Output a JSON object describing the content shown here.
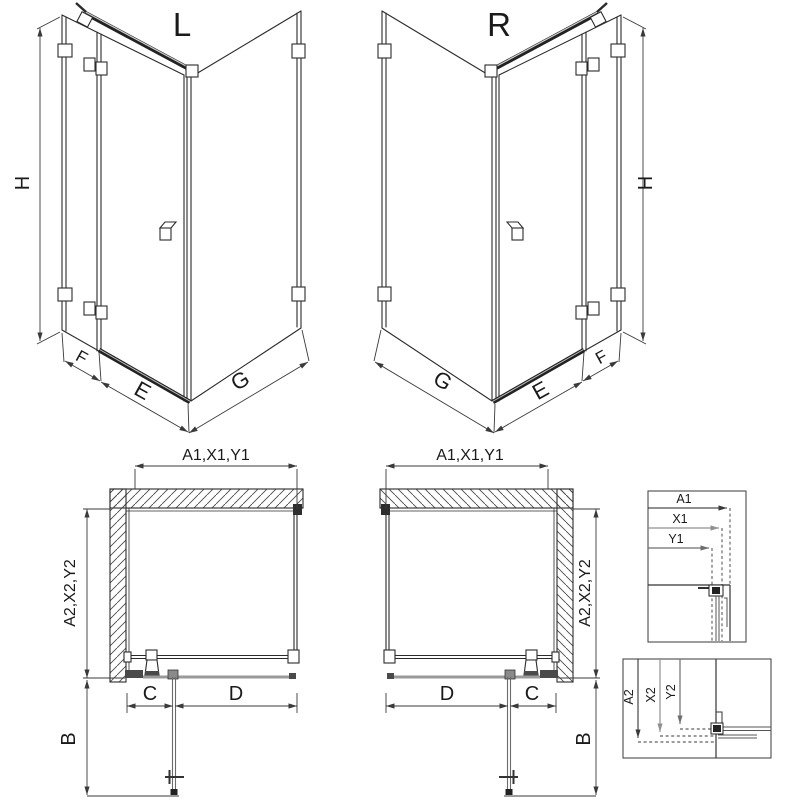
{
  "colors": {
    "line": "#2b2b2b",
    "dim": "#3a3a3a",
    "gray": "#9a9a9a",
    "background": "#ffffff"
  },
  "iso_views": {
    "left": {
      "label": "L",
      "dim_height": "H",
      "dim_fixed": "F",
      "dim_door": "E",
      "dim_side": "G"
    },
    "right": {
      "label": "R",
      "dim_height": "H",
      "dim_fixed": "F",
      "dim_door": "E",
      "dim_side": "G"
    }
  },
  "plan_views": {
    "left": {
      "dim_width": "A1,X1,Y1",
      "dim_depth": "A2,X2,Y2",
      "dim_c": "C",
      "dim_d": "D",
      "dim_b": "B"
    },
    "right": {
      "dim_width": "A1,X1,Y1",
      "dim_depth": "A2,X2,Y2",
      "dim_c": "C",
      "dim_d": "D",
      "dim_b": "B"
    }
  },
  "detail_boxes": {
    "width_box": {
      "labels": [
        "A1",
        "X1",
        "Y1"
      ]
    },
    "depth_box": {
      "labels": [
        "A2",
        "X2",
        "Y2"
      ]
    }
  }
}
